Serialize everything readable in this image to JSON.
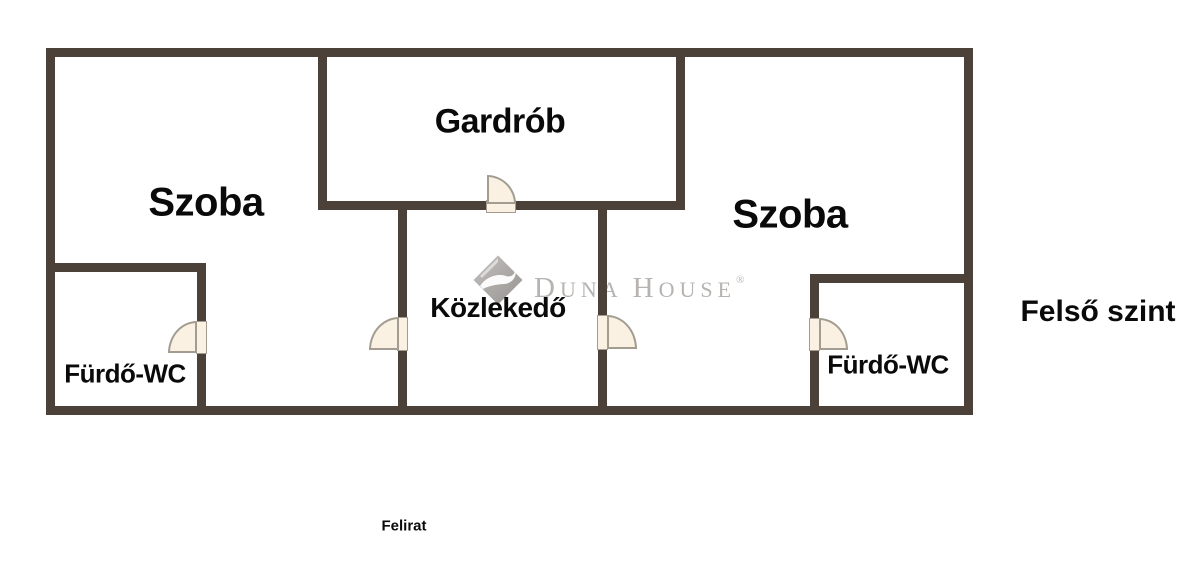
{
  "plan": {
    "rooms": [
      {
        "name": "szoba-left",
        "label": "Szoba"
      },
      {
        "name": "gardrob",
        "label": "Gardrób"
      },
      {
        "name": "szoba-right",
        "label": "Szoba"
      },
      {
        "name": "kozlekedo",
        "label": "Közlekedő"
      },
      {
        "name": "furdo-wc-left",
        "label": "Fürdő-WC"
      },
      {
        "name": "furdo-wc-right",
        "label": "Fürdő-WC"
      }
    ],
    "floor_label": "Felső szint",
    "caption": "Felirat",
    "colors": {
      "wall": "#4b4138",
      "door_fill": "#faf1e3",
      "door_stroke": "#a39d91",
      "label": "#0a0a0a",
      "background": "#ffffff",
      "watermark": "#b6b3b0"
    }
  },
  "watermark": {
    "brand": "Duna House",
    "parts": [
      "D",
      "UNA",
      "H",
      "OUSE"
    ],
    "registered": "®"
  }
}
